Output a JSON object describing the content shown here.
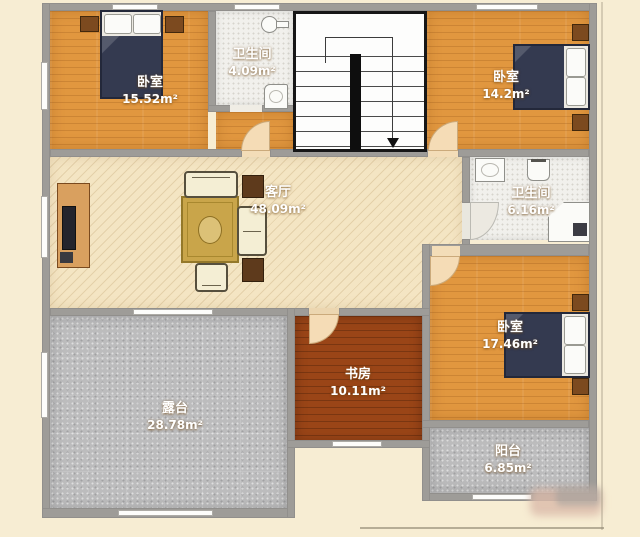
{
  "rooms": [
    {
      "name": "卧室",
      "area": "15.52m²"
    },
    {
      "name": "卫生间",
      "area": "4.09m²"
    },
    {
      "name": "卧室",
      "area": "14.2m²"
    },
    {
      "name": "客厅",
      "area": "48.09m²"
    },
    {
      "name": "卫生间",
      "area": "6.16m²"
    },
    {
      "name": "卧室",
      "area": "17.46m²"
    },
    {
      "name": "书房",
      "area": "10.11m²"
    },
    {
      "name": "露台",
      "area": "28.78m²"
    },
    {
      "name": "阳台",
      "area": "6.85m²"
    }
  ],
  "colors": {
    "wood_floor": "#e1973f",
    "study_floor": "#9a4517",
    "living_floor": "#f4e5c3",
    "gray_tile": "#bcbcbd",
    "white_tile": "#f1f0ec",
    "wall": "#9e9c98",
    "bed_blanket": "#343a50",
    "door_swing": "#f5dcb6"
  },
  "fixtures": [
    "bed",
    "pillow",
    "nightstand",
    "sofa",
    "loveseat",
    "armchair",
    "rug",
    "side-table",
    "tv-cabinet",
    "tv",
    "sink",
    "faucet",
    "toilet",
    "bathtub",
    "shower",
    "staircase",
    "down-arrow",
    "door-swing",
    "window"
  ]
}
